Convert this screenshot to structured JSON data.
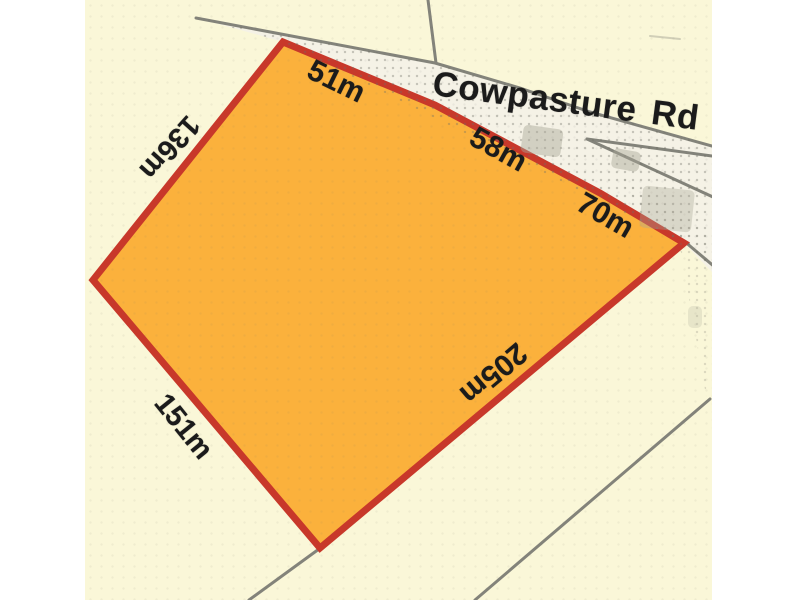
{
  "map": {
    "road": {
      "name": "Cowpasture Rd"
    },
    "parcel": {
      "fill_color": "#FBB13C",
      "border_color": "#C8382A",
      "dimensions": {
        "top_left": "51m",
        "top_middle": "58m",
        "top_right": "70m",
        "west": "136m",
        "south_west": "151m",
        "east": "205m"
      }
    },
    "background_color": "#FAF7D8",
    "road_surface_color": "#F5F2E6",
    "boundary_line_color": "#83837A",
    "label_color": "#1B1B1B"
  }
}
